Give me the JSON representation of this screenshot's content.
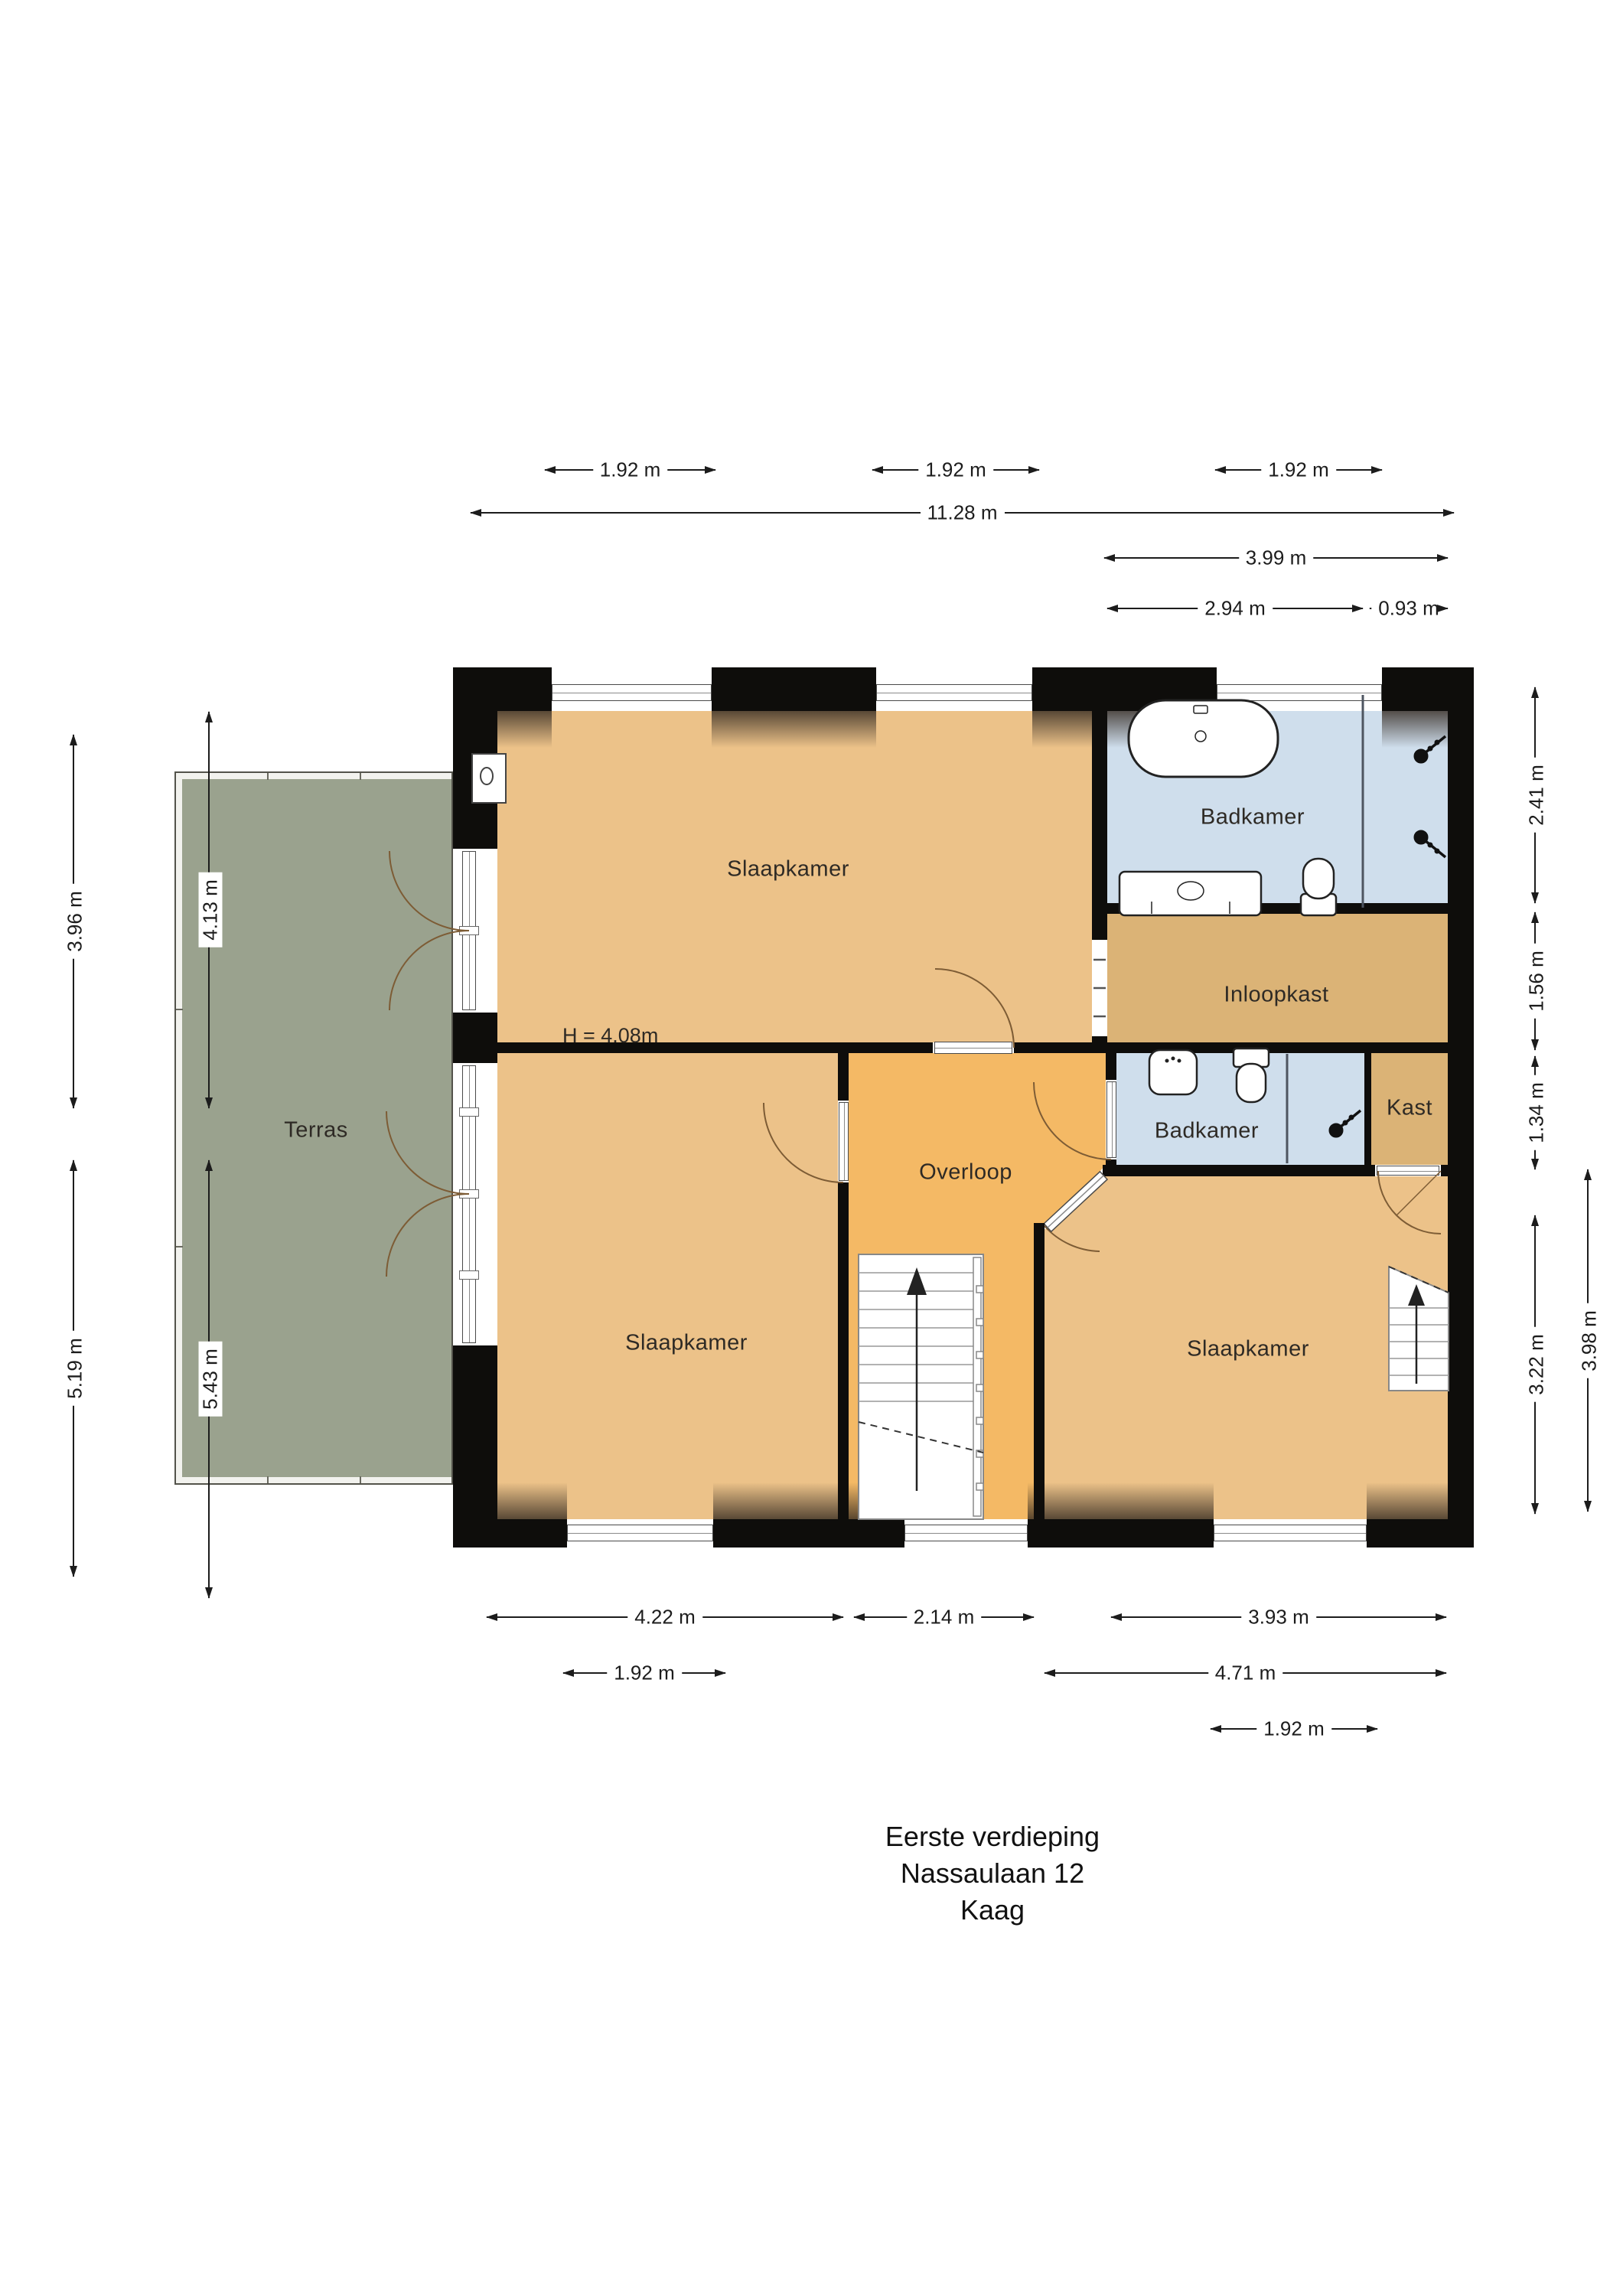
{
  "title": {
    "line1": "Eerste verdieping",
    "line2": "Nassaulaan 12",
    "line3": "Kaag"
  },
  "rooms": {
    "slaapkamer_top": {
      "label": "Slaapkamer"
    },
    "badkamer_main": {
      "label": "Badkamer"
    },
    "inloopkast": {
      "label": "Inloopkast"
    },
    "badkamer_small": {
      "label": "Badkamer"
    },
    "kast": {
      "label": "Kast"
    },
    "overloop": {
      "label": "Overloop"
    },
    "slaapkamer_left": {
      "label": "Slaapkamer"
    },
    "slaapkamer_right": {
      "label": "Slaapkamer"
    },
    "terras": {
      "label": "Terras"
    }
  },
  "annotations": {
    "ceiling_height": "H = 4.08m"
  },
  "dimensions": {
    "top": [
      {
        "label": "1.92 m"
      },
      {
        "label": "1.92 m"
      },
      {
        "label": "1.92 m"
      },
      {
        "label": "11.28 m"
      },
      {
        "label": "3.99 m"
      },
      {
        "label": "2.94 m"
      },
      {
        "label": "0.93 m"
      }
    ],
    "bottom": [
      {
        "label": "4.22 m"
      },
      {
        "label": "2.14 m"
      },
      {
        "label": "3.93 m"
      },
      {
        "label": "1.92 m"
      },
      {
        "label": "4.71 m"
      },
      {
        "label": "1.92 m"
      }
    ],
    "left": [
      {
        "label": "3.96 m"
      },
      {
        "label": "5.19 m"
      },
      {
        "label": "4.13 m"
      },
      {
        "label": "5.43 m"
      }
    ],
    "right": [
      {
        "label": "2.41 m"
      },
      {
        "label": "1.56 m"
      },
      {
        "label": "1.34 m"
      },
      {
        "label": "3.22 m"
      },
      {
        "label": "3.98 m"
      }
    ]
  },
  "colors": {
    "floor_bedroom": "#ecc289",
    "floor_hall": "#f4b965",
    "floor_bath": "#cfdeec",
    "floor_closet": "#dbb376",
    "terrace": "#9aa28e",
    "wall": "#0e0d0b"
  }
}
